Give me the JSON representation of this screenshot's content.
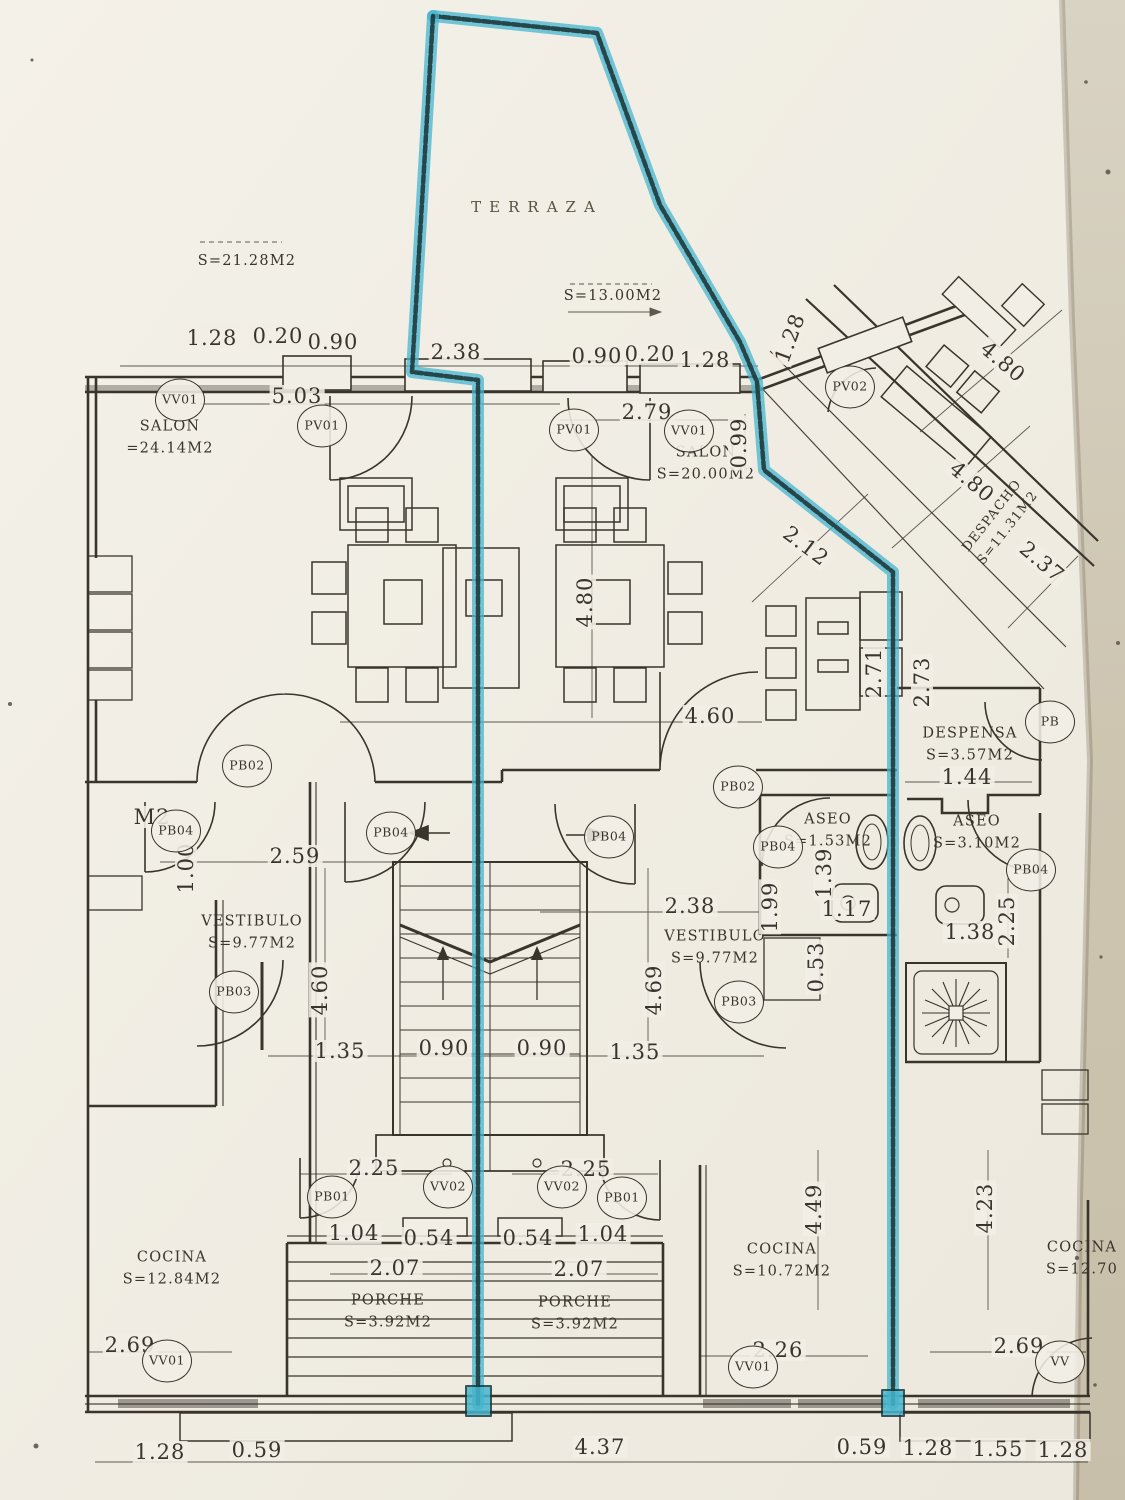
{
  "photo": {
    "background_color": "#cdc5b1",
    "paper_color": "#f1eee6",
    "ink_color": "#39342c",
    "highlight_color": "#45b6cf",
    "highlight_dark_color": "#1d3a3c"
  },
  "plan": {
    "rooms": [
      {
        "name": "TERRAZA",
        "area": "",
        "x": 537,
        "y": 207
      },
      {
        "name": "",
        "area": "S=21.28M2",
        "x": 247,
        "y": 262
      },
      {
        "name": "",
        "area": "S=13.00M2",
        "x": 613,
        "y": 297
      },
      {
        "name": "SALON",
        "area": "=24.14M2",
        "x": 170,
        "y": 438
      },
      {
        "name": "SALON",
        "area": "S=20.00M2",
        "x": 706,
        "y": 464
      },
      {
        "name": "DESPACHO",
        "area": "S=11.31M2",
        "x": 1000,
        "y": 522,
        "r": -52
      },
      {
        "name": "DESPENSA",
        "area": "S=3.57M2",
        "x": 970,
        "y": 745
      },
      {
        "name": "ASEO",
        "area": "S=1.53M2",
        "x": 828,
        "y": 831
      },
      {
        "name": "ASEO",
        "area": "S=3.10M2",
        "x": 977,
        "y": 833
      },
      {
        "name": "VESTIBULO",
        "area": "S=9.77M2",
        "x": 252,
        "y": 933
      },
      {
        "name": "VESTIBULO",
        "area": "S=9.77M2",
        "x": 715,
        "y": 948
      },
      {
        "name": "COCINA",
        "area": "S=12.84M2",
        "x": 172,
        "y": 1269
      },
      {
        "name": "COCINA",
        "area": "S=10.72M2",
        "x": 782,
        "y": 1261
      },
      {
        "name": "COCINA",
        "area": "S=12.70",
        "x": 1082,
        "y": 1259
      },
      {
        "name": "PORCHE",
        "area": "S=3.92M2",
        "x": 388,
        "y": 1312
      },
      {
        "name": "PORCHE",
        "area": "S=3.92M2",
        "x": 575,
        "y": 1314
      }
    ],
    "dims": [
      {
        "t": "1.28",
        "x": 212,
        "y": 338
      },
      {
        "t": "0.20",
        "x": 278,
        "y": 336
      },
      {
        "t": "0.90",
        "x": 333,
        "y": 342
      },
      {
        "t": "2.38",
        "x": 456,
        "y": 352
      },
      {
        "t": "0.90",
        "x": 597,
        "y": 356
      },
      {
        "t": "0.20",
        "x": 650,
        "y": 354
      },
      {
        "t": "1.28",
        "x": 705,
        "y": 360
      },
      {
        "t": "1.28",
        "x": 790,
        "y": 338,
        "r": -70
      },
      {
        "t": "5.03",
        "x": 297,
        "y": 396
      },
      {
        "t": "2.79",
        "x": 647,
        "y": 412
      },
      {
        "t": "0.99",
        "x": 739,
        "y": 443,
        "r": -90
      },
      {
        "t": "4.80",
        "x": 1003,
        "y": 362,
        "r": 40
      },
      {
        "t": "4.80",
        "x": 972,
        "y": 482,
        "r": 40
      },
      {
        "t": "2.12",
        "x": 806,
        "y": 546,
        "r": 37
      },
      {
        "t": "2.37",
        "x": 1042,
        "y": 562,
        "r": 40
      },
      {
        "t": "4.80",
        "x": 585,
        "y": 602,
        "r": -90
      },
      {
        "t": "2.71",
        "x": 874,
        "y": 673,
        "r": -90
      },
      {
        "t": "2.73",
        "x": 922,
        "y": 682,
        "r": -90
      },
      {
        "t": "4.60",
        "x": 710,
        "y": 716
      },
      {
        "t": "1.44",
        "x": 967,
        "y": 777
      },
      {
        "t": "M2",
        "x": 152,
        "y": 817
      },
      {
        "t": "2.59",
        "x": 295,
        "y": 856
      },
      {
        "t": "1.00",
        "x": 186,
        "y": 868,
        "r": -90
      },
      {
        "t": "2.38",
        "x": 690,
        "y": 906
      },
      {
        "t": "1.99",
        "x": 770,
        "y": 907,
        "r": -90
      },
      {
        "t": "1.39",
        "x": 824,
        "y": 873,
        "r": -90
      },
      {
        "t": "1.17",
        "x": 847,
        "y": 909
      },
      {
        "t": "1.38",
        "x": 970,
        "y": 932
      },
      {
        "t": "2.25",
        "x": 1007,
        "y": 921,
        "r": -90
      },
      {
        "t": "0.53",
        "x": 816,
        "y": 967,
        "r": -90
      },
      {
        "t": "4.60",
        "x": 320,
        "y": 990,
        "r": -90
      },
      {
        "t": "4.69",
        "x": 654,
        "y": 990,
        "r": -90
      },
      {
        "t": "1.35",
        "x": 340,
        "y": 1051
      },
      {
        "t": "0.90",
        "x": 444,
        "y": 1048
      },
      {
        "t": "0.90",
        "x": 542,
        "y": 1048
      },
      {
        "t": "1.35",
        "x": 635,
        "y": 1052
      },
      {
        "t": "2.25",
        "x": 374,
        "y": 1168
      },
      {
        "t": "2.25",
        "x": 586,
        "y": 1169
      },
      {
        "t": "1.04",
        "x": 354,
        "y": 1233
      },
      {
        "t": "0.54",
        "x": 429,
        "y": 1238
      },
      {
        "t": "0.54",
        "x": 528,
        "y": 1238
      },
      {
        "t": "1.04",
        "x": 603,
        "y": 1234
      },
      {
        "t": "2.07",
        "x": 395,
        "y": 1268
      },
      {
        "t": "2.07",
        "x": 579,
        "y": 1269
      },
      {
        "t": "2.69",
        "x": 130,
        "y": 1345
      },
      {
        "t": "2.26",
        "x": 778,
        "y": 1350
      },
      {
        "t": "2.69",
        "x": 1019,
        "y": 1346
      },
      {
        "t": "4.49",
        "x": 814,
        "y": 1209,
        "r": -90
      },
      {
        "t": "4.23",
        "x": 985,
        "y": 1208,
        "r": -90
      },
      {
        "t": "1.28",
        "x": 160,
        "y": 1452
      },
      {
        "t": "0.59",
        "x": 257,
        "y": 1450
      },
      {
        "t": "4.37",
        "x": 600,
        "y": 1447
      },
      {
        "t": "0.59",
        "x": 862,
        "y": 1447
      },
      {
        "t": "1.28",
        "x": 928,
        "y": 1448
      },
      {
        "t": "1.55",
        "x": 998,
        "y": 1449
      },
      {
        "t": "1.28",
        "x": 1063,
        "y": 1450
      }
    ],
    "codes": [
      {
        "t": "VV01",
        "x": 180,
        "y": 400
      },
      {
        "t": "PV01",
        "x": 322,
        "y": 426
      },
      {
        "t": "PV01",
        "x": 574,
        "y": 430
      },
      {
        "t": "VV01",
        "x": 689,
        "y": 431
      },
      {
        "t": "PV02",
        "x": 850,
        "y": 387
      },
      {
        "t": "PB02",
        "x": 247,
        "y": 766
      },
      {
        "t": "PB02",
        "x": 738,
        "y": 787
      },
      {
        "t": "PB04",
        "x": 176,
        "y": 831
      },
      {
        "t": "PB04",
        "x": 391,
        "y": 833
      },
      {
        "t": "PB04",
        "x": 609,
        "y": 837
      },
      {
        "t": "PB04",
        "x": 778,
        "y": 847
      },
      {
        "t": "PB04",
        "x": 1031,
        "y": 870
      },
      {
        "t": "PB",
        "x": 1050,
        "y": 722
      },
      {
        "t": "PB03",
        "x": 234,
        "y": 992
      },
      {
        "t": "PB03",
        "x": 739,
        "y": 1002
      },
      {
        "t": "PB01",
        "x": 332,
        "y": 1197
      },
      {
        "t": "VV02",
        "x": 448,
        "y": 1187
      },
      {
        "t": "VV02",
        "x": 562,
        "y": 1187
      },
      {
        "t": "PB01",
        "x": 622,
        "y": 1198
      },
      {
        "t": "VV01",
        "x": 167,
        "y": 1361
      },
      {
        "t": "VV01",
        "x": 753,
        "y": 1367
      },
      {
        "t": "VV",
        "x": 1060,
        "y": 1362
      }
    ]
  }
}
